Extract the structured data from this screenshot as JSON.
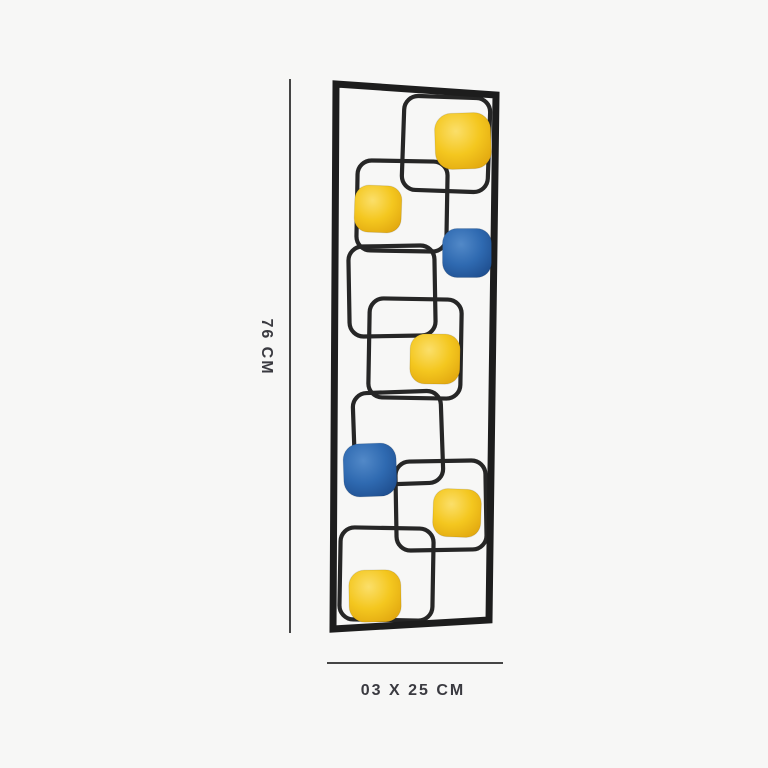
{
  "canvas": {
    "width": 768,
    "height": 768,
    "background": "#f7f7f6"
  },
  "dimension_labels": {
    "height": "76 CM",
    "width_depth": "03 X 25 CM"
  },
  "annotation_style": {
    "line_color": "#454545",
    "text_color": "#3a3a40"
  },
  "dimension_lines": {
    "vertical": {
      "x": 289,
      "y1": 79,
      "y2": 633,
      "thickness": 1.6
    },
    "horizontal": {
      "y": 662,
      "x1": 327,
      "x2": 503,
      "thickness": 1.6
    }
  },
  "label_positions": {
    "height_label": {
      "x": 266,
      "y": 347
    },
    "width_depth_label": {
      "x": 413,
      "y": 691
    }
  },
  "artwork": {
    "frame": {
      "color": "#1d1d1d",
      "stroke_width": 7,
      "points": "336,84 496,95 489,620 333,629"
    },
    "wire": {
      "color": "#262626",
      "stroke_width": 4.2,
      "corner_radius": 14
    },
    "palette": {
      "yellow_center": "#fbdf6a",
      "yellow_mid": "#f4c71f",
      "yellow_edge": "#dfa30d",
      "blue_center": "#5289c8",
      "blue_mid": "#2f6ab1",
      "blue_edge": "#1c4a8a"
    },
    "wire_squares": [
      {
        "x": 403,
        "y": 97,
        "w": 86,
        "h": 94,
        "rot": 2
      },
      {
        "x": 357,
        "y": 161,
        "w": 90,
        "h": 90,
        "rot": 1
      },
      {
        "x": 349,
        "y": 246,
        "w": 86,
        "h": 90,
        "rot": -1
      },
      {
        "x": 369,
        "y": 299,
        "w": 92,
        "h": 99,
        "rot": 1
      },
      {
        "x": 354,
        "y": 392,
        "w": 88,
        "h": 92,
        "rot": -2
      },
      {
        "x": 396,
        "y": 461,
        "w": 90,
        "h": 89,
        "rot": -1
      },
      {
        "x": 340,
        "y": 528,
        "w": 93,
        "h": 92,
        "rot": 1
      }
    ],
    "filled_squares": [
      {
        "color": "yellow",
        "cx": 463,
        "cy": 141,
        "size": 56,
        "rot": -2
      },
      {
        "color": "yellow",
        "cx": 378,
        "cy": 209,
        "size": 47,
        "rot": 2
      },
      {
        "color": "blue",
        "cx": 467,
        "cy": 253,
        "size": 49,
        "rot": 0
      },
      {
        "color": "yellow",
        "cx": 435,
        "cy": 359,
        "size": 50,
        "rot": 1
      },
      {
        "color": "blue",
        "cx": 370,
        "cy": 470,
        "size": 53,
        "rot": -2
      },
      {
        "color": "yellow",
        "cx": 457,
        "cy": 513,
        "size": 48,
        "rot": 2
      },
      {
        "color": "yellow",
        "cx": 375,
        "cy": 596,
        "size": 52,
        "rot": -1
      }
    ]
  }
}
